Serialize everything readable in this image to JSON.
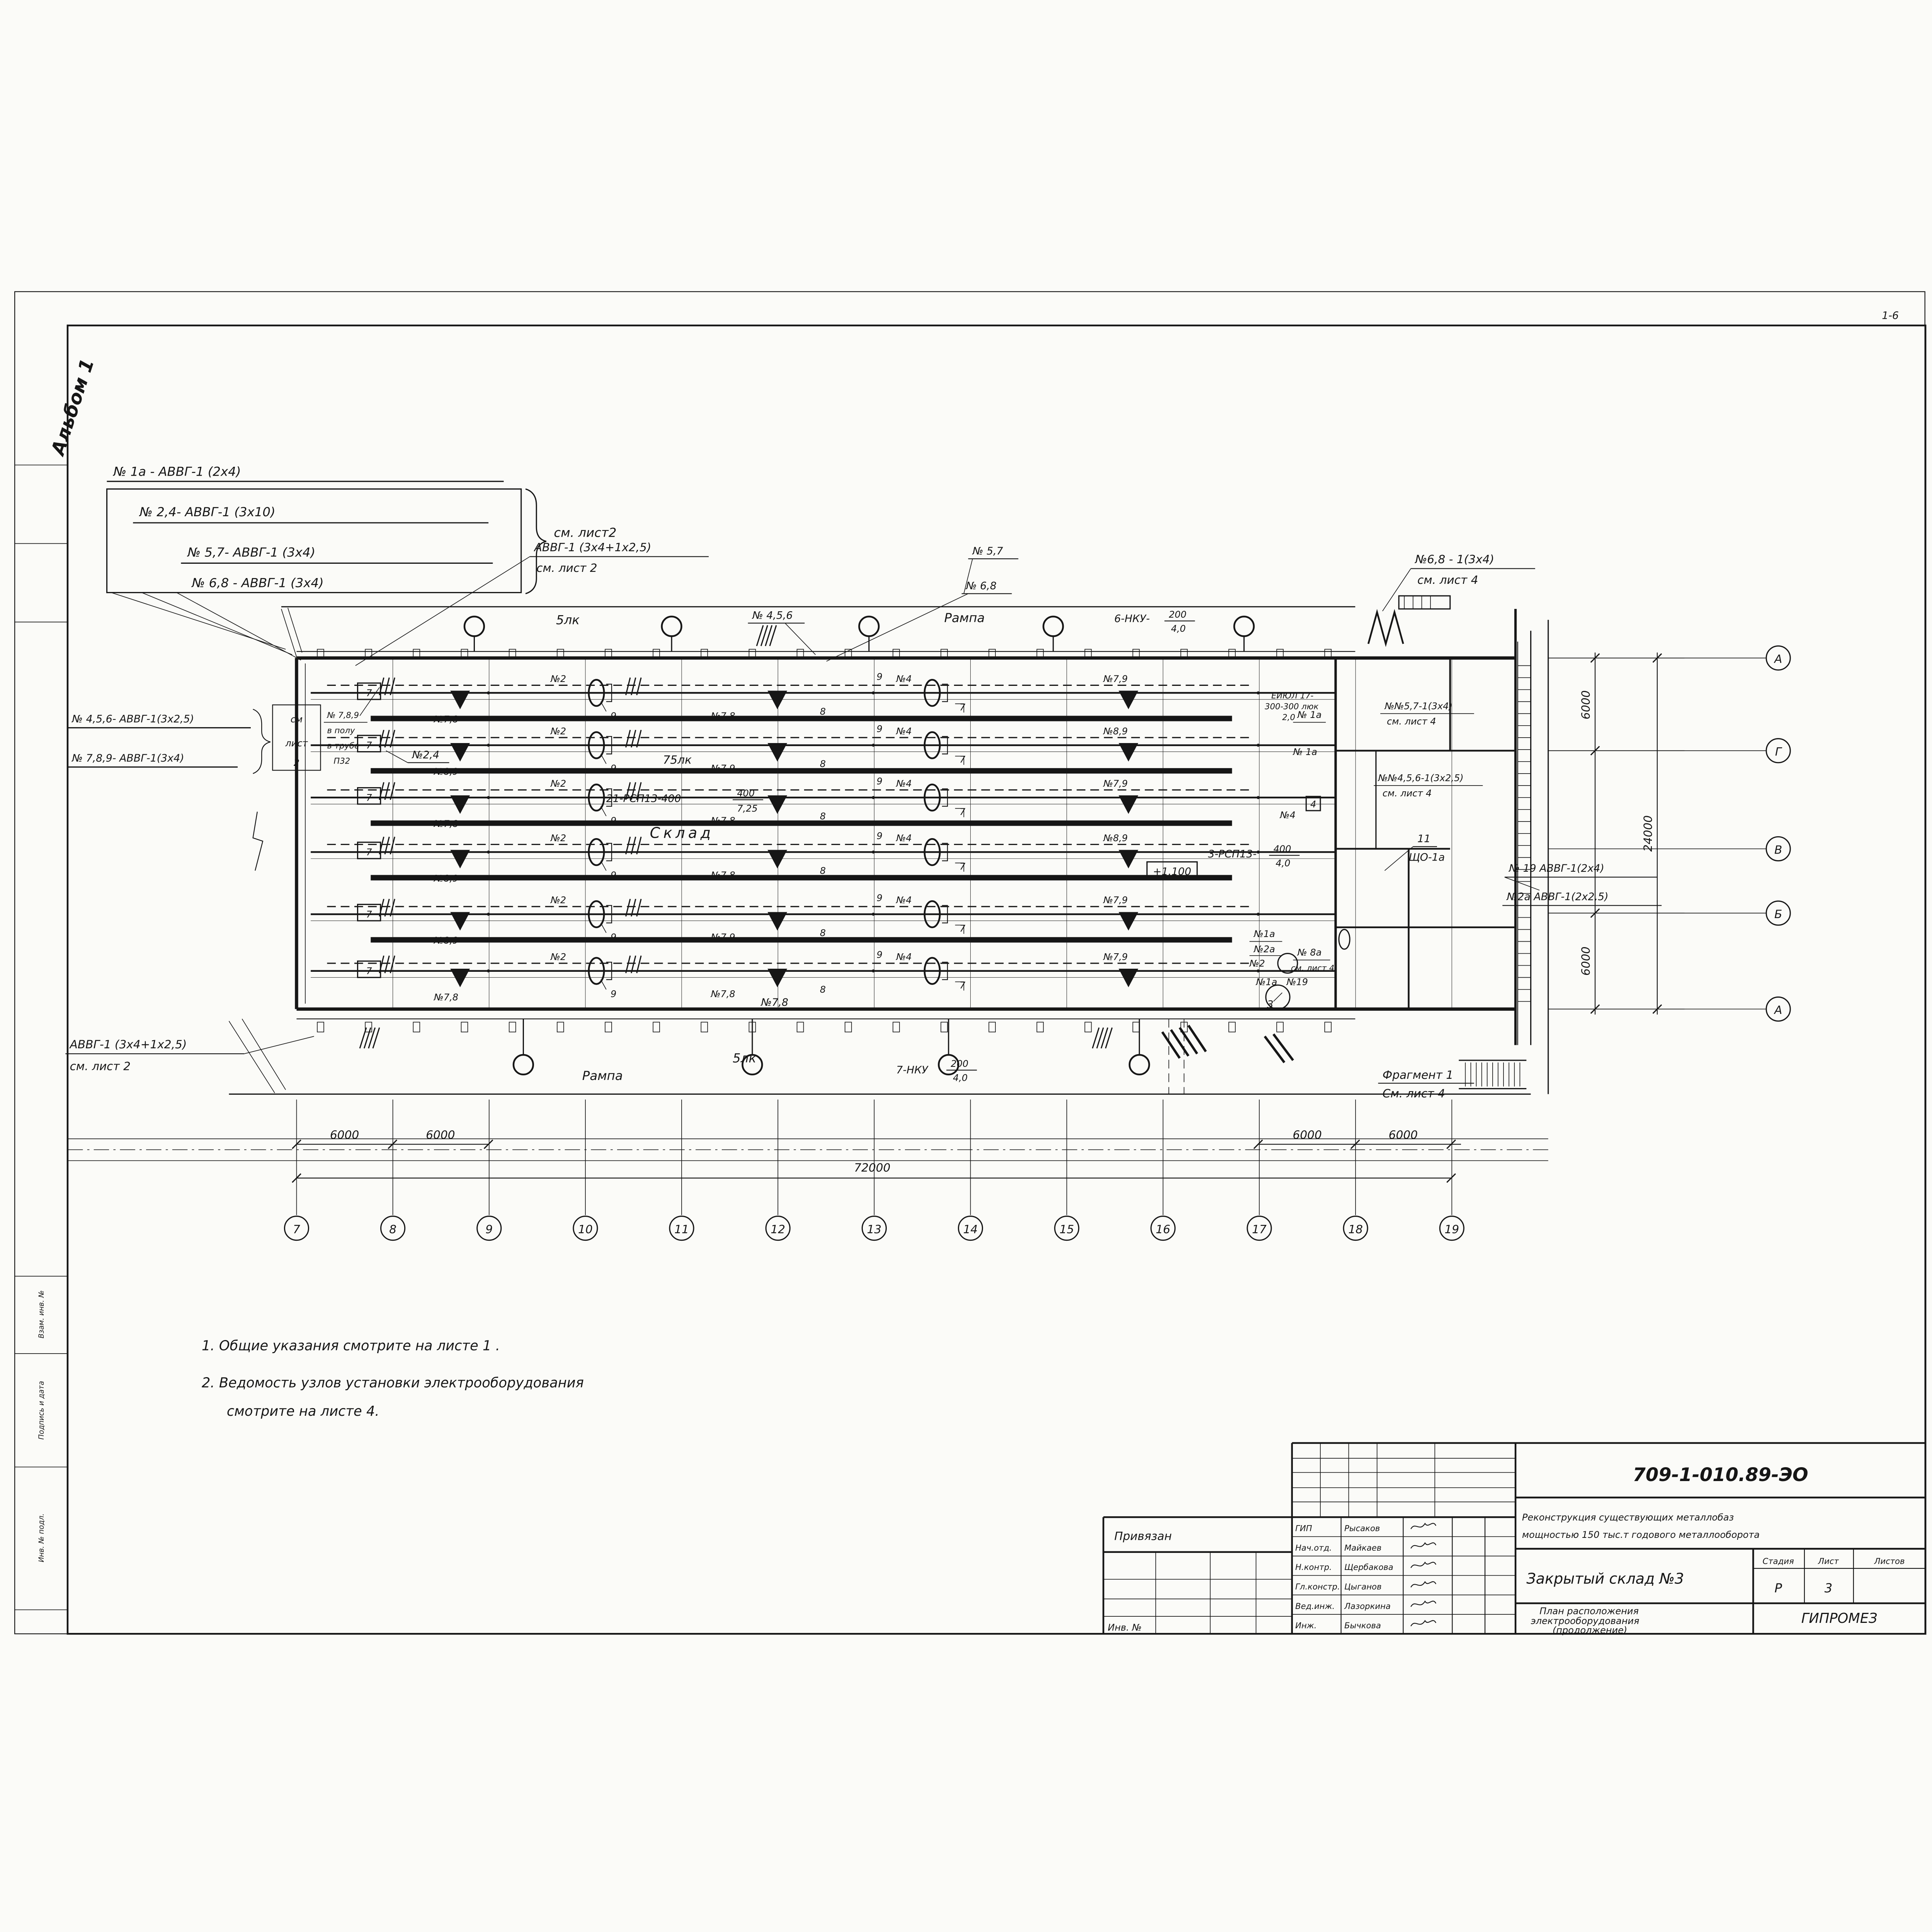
{
  "corner_mark": "1-6",
  "album": "Альбом 1",
  "side_stamps": {
    "s1": "Взам. инв. №",
    "s2": "Подпись и дата",
    "s3": "Инв. № подл."
  },
  "cable_list_top": {
    "l1": "№ 1а - АВВГ-1  (2х4)",
    "l2": "№ 2,4- АВВГ-1 (3х10)",
    "l3": "№ 5,7- АВВГ-1 (3х4)",
    "l4": "№ 6,8 - АВВГ-1  (3х4)",
    "see": "см. лист2"
  },
  "callout_top_mid": {
    "cable": "АВВГ-1 (3х4+1х2,5)",
    "see": "см. лист 2"
  },
  "cable_list_left": {
    "l1": "№ 4,5,6- АВВГ-1(3х2,5)",
    "l2": "№ 7,8,9- АВВГ-1(3х4)",
    "see1": "см",
    "see2": "лист",
    "see3": "2",
    "note1": "№ 7,8,9",
    "note2": "в полу",
    "note3": "в трубе",
    "note4": "П32"
  },
  "callout_bottom_left": {
    "cable": "АВВГ-1 (3х4+1х2,5)",
    "see": "см. лист 2"
  },
  "callout_top_right": {
    "line1": "№6,8 - 1(3х4)",
    "see": "см. лист 4"
  },
  "annex_callouts": {
    "a1": "№№5,7-1(3х4)",
    "a1see": "см. лист 4",
    "a2": "№№4,5,6-1(3х2,5)",
    "a2see": "см. лист 4",
    "e1": "ЕИЮЛ 17-",
    "e2": "300-300 люк",
    "e3": "2,0",
    "n1": "№ 1а",
    "n2": "№ 1а",
    "n3": "№4",
    "n4": "4",
    "n5": "№1а",
    "n6": "№2а",
    "n7": "№2",
    "n8": "№ 8а",
    "n8see": "см. лист 4",
    "n9": "№1а",
    "n10": "№19",
    "n11": "3",
    "shield_num": "11",
    "shield": "ЩО-1а"
  },
  "top_band": {
    "lk": "5лк",
    "group": "№ 4,5,6",
    "rampa": "Рампа",
    "nku": "6-НКУ-",
    "nku_num": "200",
    "nku_den": "4,0",
    "c1": "№ 5,7",
    "c2": "№ 6,8"
  },
  "bottom_band": {
    "rampa": "Рампа",
    "lk": "5лк",
    "nku": "7-НКУ",
    "nku_num": "200",
    "nku_den": "4,0",
    "group": "№7,8"
  },
  "interior": {
    "call_24": "№2,4",
    "lk75": "75лк",
    "rsp21": "21-РСП13-400",
    "rsp21_num": "400",
    "rsp21_den": "7,25",
    "sklad": "Склад",
    "rsp3": "3-РСП13-",
    "rsp3_num": "400",
    "rsp3_den": "4,0",
    "elev": "+1.100"
  },
  "rows": [
    {
      "panel": "7",
      "left": "№7,8",
      "oval_a": "№2",
      "g9a": "9",
      "mid": "№7,8",
      "g9b": "9",
      "oval_b": "№4",
      "g7": "7",
      "g8": "8",
      "right": "№7,9"
    },
    {
      "panel": "7",
      "left": "№8,9",
      "oval_a": "№2",
      "g9a": "9",
      "mid": "№7,9",
      "g9b": "9",
      "oval_b": "№4",
      "g7": "7",
      "g8": "8",
      "right": "№8,9"
    },
    {
      "panel": "7",
      "left": "№7,8",
      "oval_a": "№2",
      "g9a": "9",
      "mid": "№7,8",
      "g9b": "9",
      "oval_b": "№4",
      "g7": "7",
      "g8": "8",
      "right": "№7,9"
    },
    {
      "panel": "7",
      "left": "№8,9",
      "oval_a": "№2",
      "g9a": "9",
      "mid": "№7,8",
      "g9b": "9",
      "oval_b": "№4",
      "g7": "7",
      "g8": "8",
      "right": "№8,9"
    },
    {
      "panel": "7",
      "left": "№8,9",
      "oval_a": "№2",
      "g9a": "9",
      "mid": "№7,9",
      "g9b": "9",
      "oval_b": "№4",
      "g7": "7",
      "g8": "8",
      "right": "№7,9"
    },
    {
      "panel": "7",
      "left": "№7,8",
      "oval_a": "№2",
      "g9a": "9",
      "mid": "№7,8",
      "g9b": "9",
      "oval_b": "№4",
      "g7": "7",
      "g8": "8",
      "right": "№7,9"
    }
  ],
  "fragment": {
    "line1": "Фрагмент 1",
    "line2": "См. лист 4"
  },
  "right_cables": {
    "c1": "№ 19 АВВГ-1(2х4)",
    "c2": "№2а АВВГ-1(2х2,5)"
  },
  "axes": {
    "bottom": [
      "7",
      "8",
      "9",
      "10",
      "11",
      "12",
      "13",
      "14",
      "15",
      "16",
      "17",
      "18",
      "19"
    ],
    "right": [
      "А",
      "Г",
      "В",
      "Б",
      "А"
    ]
  },
  "dims": {
    "b1": "6000",
    "b2": "6000",
    "b3": "6000",
    "b4": "6000",
    "total": "72000",
    "r1": "6000",
    "r2": "24000",
    "r3": "6000"
  },
  "notes": {
    "n1": "1. Общие  указания  смотрите  на  листе 1 .",
    "n2": "2. Ведомость  узлов  установки  электрооборудования",
    "n3": "смотрите  на  листе 4."
  },
  "title_block": {
    "doc_number": "709-1-010.89-ЭО",
    "project1": "Реконструкция существующих металлобаз",
    "project2": "мощностью 150 тыс.т годового металлооборота",
    "object": "Закрытый склад №3",
    "stage_label": "Стадия",
    "sheet_label": "Лист",
    "sheets_label": "Листов",
    "stage": "Р",
    "sheet": "3",
    "sheets": "",
    "title1": "План расположения",
    "title2": "электрооборудования",
    "title3": "(продолжение)",
    "org": "ГИПРОМЕЗ",
    "binding": "Привязан",
    "inv": "Инв. №",
    "personnel": [
      {
        "role": "ГИП",
        "name": "Рысаков"
      },
      {
        "role": "Нач.отд.",
        "name": "Майкаев"
      },
      {
        "role": "Н.контр.",
        "name": "Щербакова"
      },
      {
        "role": "Гл.констр.",
        "name": "Цыганов"
      },
      {
        "role": "Вед.инж.",
        "name": "Лазоркина"
      },
      {
        "role": "Инж.",
        "name": "Бычкова"
      }
    ]
  }
}
